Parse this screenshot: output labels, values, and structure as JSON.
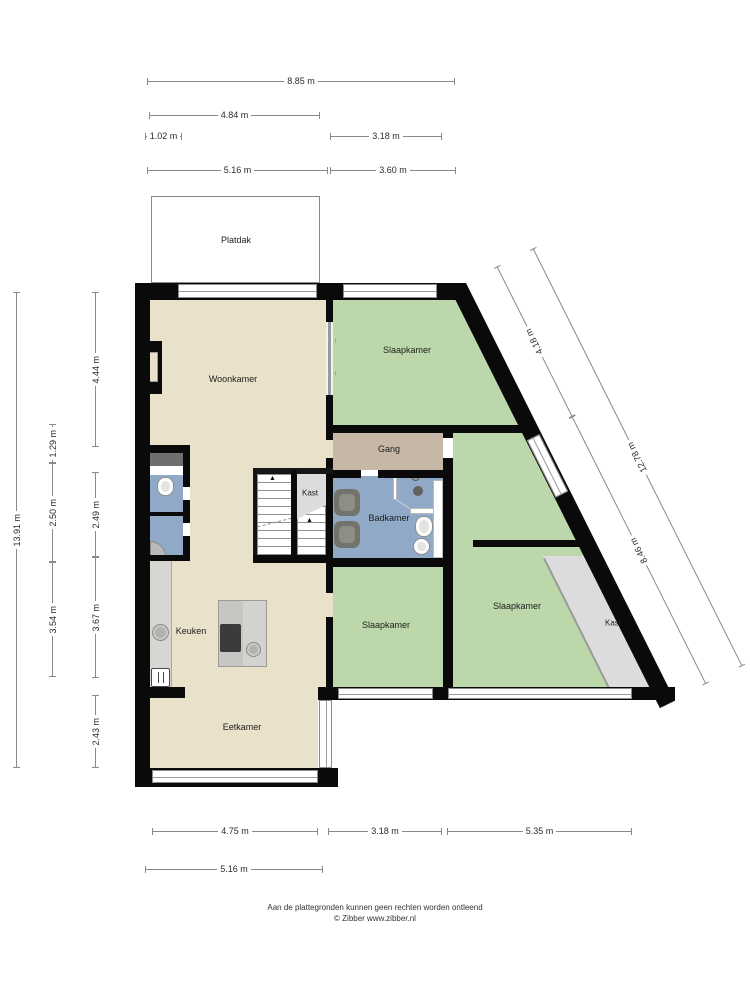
{
  "rooms": {
    "platdak": "Platdak",
    "woonkamer": "Woonkamer",
    "slaapkamer_top": "Slaapkamer",
    "gang": "Gang",
    "kast_stairs": "Kast",
    "badkamer": "Badkamer",
    "slaapkamer_left": "Slaapkamer",
    "slaapkamer_right": "Slaapkamer",
    "kast_right": "Kast",
    "keuken": "Keuken",
    "eetkamer": "Eetkamer"
  },
  "dimensions": {
    "top": [
      "8.85 m",
      "4.84 m",
      "1.02 m",
      "3.18 m",
      "5.16 m",
      "3.60 m"
    ],
    "left_outer": "13.91 m",
    "left_mid": [
      "1.29 m",
      "2.50 m",
      "3.54 m"
    ],
    "left_inner": [
      "4.44 m",
      "2.49 m",
      "3.67 m",
      "2.43 m"
    ],
    "diagonal": [
      "4.18 m",
      "12.78 m",
      "8.46 m"
    ],
    "bottom": [
      "4.75 m",
      "3.18 m",
      "5.35 m",
      "5.16 m"
    ]
  },
  "footer": {
    "line1": "Aan de plattegronden kunnen geen rechten worden ontleend",
    "line2": "© Zibber www.zibber.nl"
  },
  "colors": {
    "wall": "#0a0a0a",
    "floor_living": "#e9e1c9",
    "floor_bedroom": "#bcd8ab",
    "floor_hall": "#c7b7a6",
    "floor_bath": "#8fa9c7",
    "floor_closet": "#dcdcdc",
    "window": "#ffffff",
    "dimension_line": "#8a8a8a",
    "text": "#222222"
  }
}
